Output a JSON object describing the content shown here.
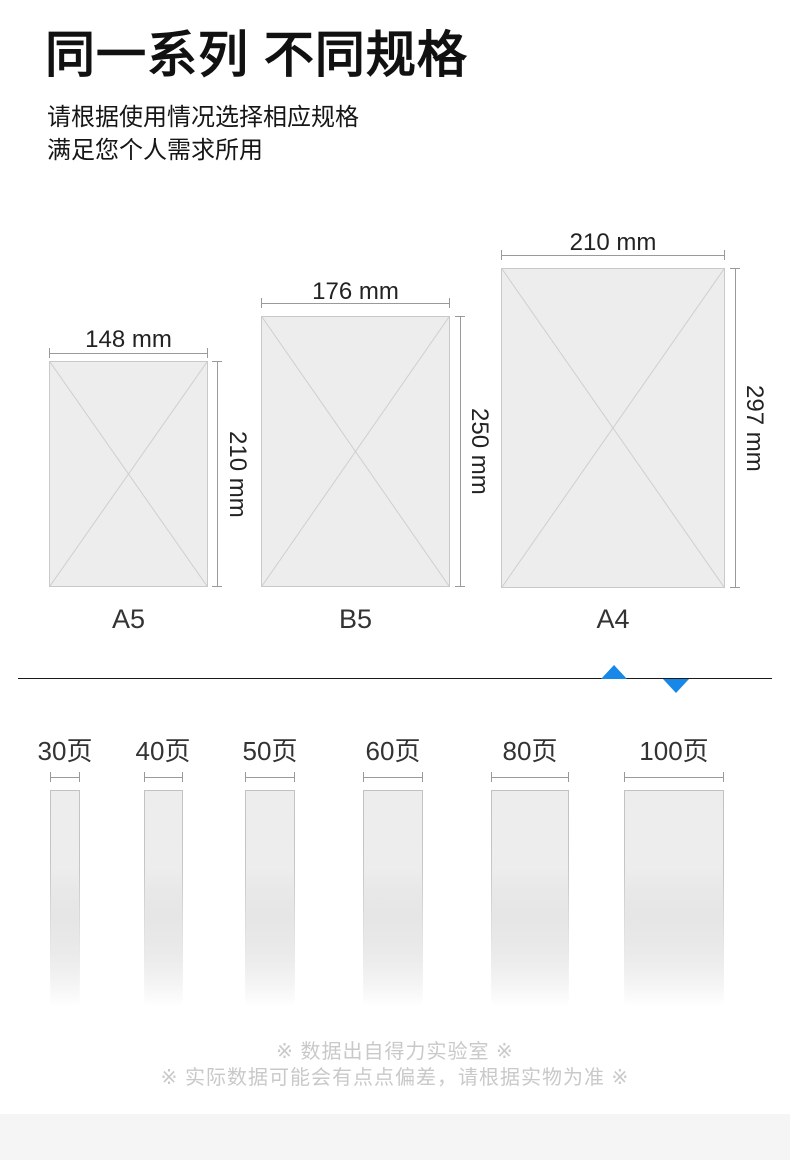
{
  "header": {
    "title": "同一系列 不同规格",
    "subtitle_line1": "请根据使用情况选择相应规格",
    "subtitle_line2": "满足您个人需求所用"
  },
  "papers": [
    {
      "label": "A5",
      "width_label": "148 mm",
      "height_label": "210 mm",
      "width_mm": 148,
      "height_mm": 210
    },
    {
      "label": "B5",
      "width_label": "176 mm",
      "height_label": "250 mm",
      "width_mm": 176,
      "height_mm": 250
    },
    {
      "label": "A4",
      "width_label": "210 mm",
      "height_label": "297 mm",
      "width_mm": 210,
      "height_mm": 297
    }
  ],
  "page_counts": [
    {
      "label": "30页",
      "pages": 30
    },
    {
      "label": "40页",
      "pages": 40
    },
    {
      "label": "50页",
      "pages": 50
    },
    {
      "label": "60页",
      "pages": 60
    },
    {
      "label": "80页",
      "pages": 80
    },
    {
      "label": "100页",
      "pages": 100
    }
  ],
  "footer": {
    "note_line1": "※ 数据出自得力实验室 ※",
    "note_line2": "※ 实际数据可能会有点点偏差，请根据实物为准 ※"
  },
  "colors": {
    "accent_blue": "#1788e7",
    "paper_fill": "#ededed",
    "paper_border": "#c9c9c9",
    "dimension_line": "#9a9a9a",
    "divider_line": "#1a1a1a",
    "footer_text": "#c9c9c9",
    "bottom_band": "#f5f5f5"
  }
}
